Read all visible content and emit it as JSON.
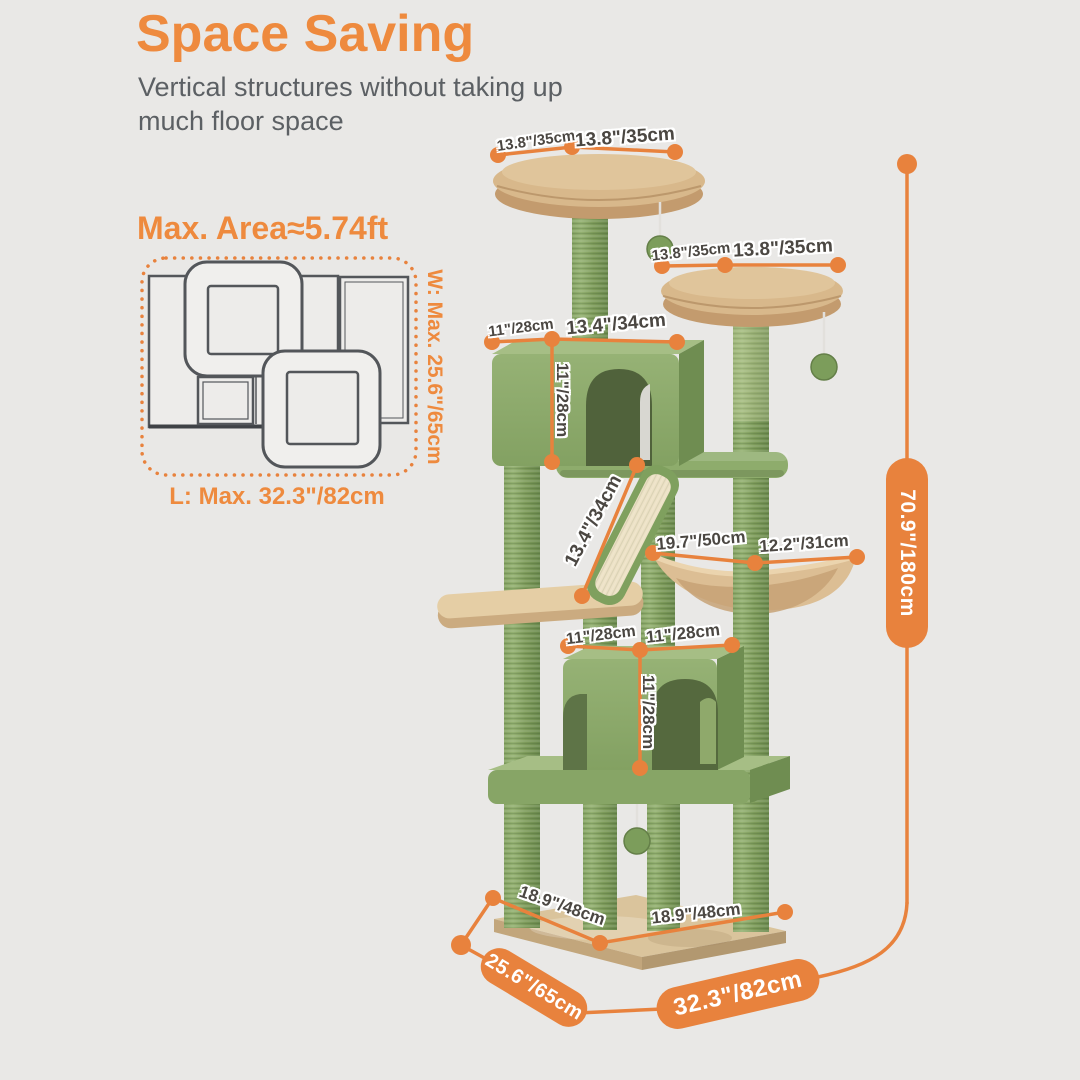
{
  "page": {
    "colors": {
      "background": "#E9E8E6",
      "accent_orange": "#E8823D",
      "title_orange": "#EE8A3E",
      "text_gray": "#5C6064",
      "plush_green": "#8FAC6D",
      "perch_tan": "#D8B88B"
    }
  },
  "header": {
    "title": "Space Saving",
    "subtitle": "Vertical structures without taking up\nmuch floor space"
  },
  "footprint": {
    "area_title": "Max. Area≈5.74ft",
    "width_label": "W: Max. 25.6\"/65cm",
    "length_label": "L: Max. 32.3\"/82cm"
  },
  "dims": {
    "top_perch_a": "13.8\"/35cm",
    "top_perch_b": "13.8\"/35cm",
    "second_perch_a": "13.8\"/35cm",
    "second_perch_b": "13.8\"/35cm",
    "upper_condo_depth": "11\"/28cm",
    "upper_condo_width": "13.4\"/34cm",
    "upper_condo_height": "11\"/28cm",
    "ramp_length": "13.4\"/34cm",
    "hammock_span": "19.7\"/50cm",
    "hammock_width": "12.2\"/31cm",
    "lower_condo_depth": "11\"/28cm",
    "lower_condo_width": "11\"/28cm",
    "lower_condo_height": "11\"/28cm",
    "base_depth": "18.9\"/48cm",
    "base_width": "18.9\"/48cm"
  },
  "overall": {
    "depth": "25.6\"/65cm",
    "width": "32.3\"/82cm",
    "height": "70.9\"/180cm"
  }
}
